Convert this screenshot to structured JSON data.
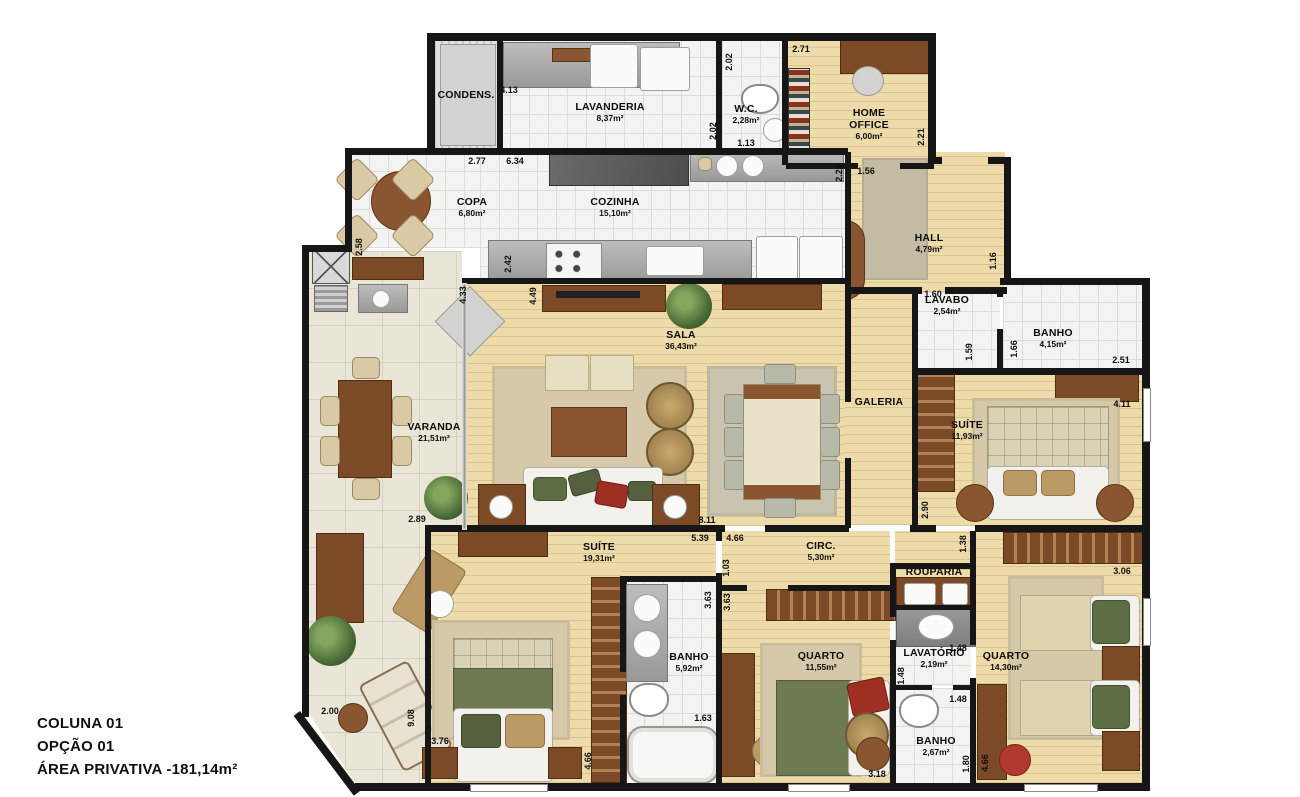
{
  "floorplan": {
    "footer": {
      "line1": "COLUNA 01",
      "line2": "OPÇÃO 01",
      "line3": "ÁREA PRIVATIVA -181,14m²"
    },
    "colors": {
      "wall": "#161616",
      "wood_floor": "#eedbaa",
      "tile_floor": "#f3f3f1",
      "varanda_floor": "#eae6d7",
      "furniture_brown": "#8a5531"
    },
    "rooms": [
      {
        "id": "condens",
        "name": "CONDENS.",
        "area": "",
        "x": 466,
        "y": 95
      },
      {
        "id": "lavanderia",
        "name": "LAVANDERIA",
        "area": "8,37m²",
        "x": 610,
        "y": 112
      },
      {
        "id": "wc",
        "name": "W.C.",
        "area": "2,28m²",
        "x": 746,
        "y": 114
      },
      {
        "id": "home-office",
        "name": "HOME OFFICE",
        "area": "6,00m²",
        "x": 869,
        "y": 124,
        "wrap": true
      },
      {
        "id": "copa",
        "name": "COPA",
        "area": "6,80m²",
        "x": 472,
        "y": 207
      },
      {
        "id": "cozinha",
        "name": "COZINHA",
        "area": "15,10m²",
        "x": 615,
        "y": 207
      },
      {
        "id": "hall",
        "name": "HALL",
        "area": "4,79m²",
        "x": 929,
        "y": 243
      },
      {
        "id": "lavabo",
        "name": "LAVABO",
        "area": "2,54m²",
        "x": 947,
        "y": 305
      },
      {
        "id": "banho-social",
        "name": "BANHO",
        "area": "4,15m²",
        "x": 1053,
        "y": 338
      },
      {
        "id": "sala",
        "name": "SALA",
        "area": "36,43m²",
        "x": 681,
        "y": 340
      },
      {
        "id": "galeria",
        "name": "GALERIA",
        "area": "",
        "x": 879,
        "y": 402
      },
      {
        "id": "varanda",
        "name": "VARANDA",
        "area": "21,51m²",
        "x": 434,
        "y": 432
      },
      {
        "id": "suite-1",
        "name": "SUÍTE",
        "area": "11,93m²",
        "x": 967,
        "y": 430
      },
      {
        "id": "suite-2",
        "name": "SUÍTE",
        "area": "19,31m²",
        "x": 599,
        "y": 552
      },
      {
        "id": "circ",
        "name": "CIRC.",
        "area": "5,30m²",
        "x": 821,
        "y": 551
      },
      {
        "id": "rouparia",
        "name": "ROUPARIA",
        "area": "",
        "x": 934,
        "y": 572
      },
      {
        "id": "banho-suite",
        "name": "BANHO",
        "area": "5,92m²",
        "x": 689,
        "y": 662
      },
      {
        "id": "quarto-1",
        "name": "QUARTO",
        "area": "11,55m²",
        "x": 821,
        "y": 661
      },
      {
        "id": "lavatorio",
        "name": "LAVATÓRIO",
        "area": "2,19m²",
        "x": 934,
        "y": 658
      },
      {
        "id": "quarto-2",
        "name": "QUARTO",
        "area": "14,30m²",
        "x": 1006,
        "y": 661
      },
      {
        "id": "banho-3",
        "name": "BANHO",
        "area": "2,67m²",
        "x": 936,
        "y": 746
      }
    ],
    "dimensions": [
      {
        "t": "4.13",
        "x": 509,
        "y": 90
      },
      {
        "t": "2.02",
        "x": 729,
        "y": 62,
        "v": 1
      },
      {
        "t": "2.71",
        "x": 801,
        "y": 49
      },
      {
        "t": "2.02",
        "x": 713,
        "y": 131,
        "v": 1
      },
      {
        "t": "1.13",
        "x": 746,
        "y": 143
      },
      {
        "t": "2.77",
        "x": 477,
        "y": 161
      },
      {
        "t": "6.34",
        "x": 515,
        "y": 161
      },
      {
        "t": "2.23",
        "x": 839,
        "y": 173,
        "v": 1
      },
      {
        "t": "1.56",
        "x": 866,
        "y": 171
      },
      {
        "t": "2.21",
        "x": 921,
        "y": 137,
        "v": 1
      },
      {
        "t": "2.58",
        "x": 359,
        "y": 247,
        "v": 1
      },
      {
        "t": "2.42",
        "x": 508,
        "y": 264,
        "v": 1
      },
      {
        "t": "1.16",
        "x": 993,
        "y": 261,
        "v": 1
      },
      {
        "t": "1.60",
        "x": 933,
        "y": 294
      },
      {
        "t": "1.59",
        "x": 969,
        "y": 352,
        "v": 1
      },
      {
        "t": "1.66",
        "x": 1014,
        "y": 349,
        "v": 1
      },
      {
        "t": "2.51",
        "x": 1121,
        "y": 360
      },
      {
        "t": "4.33",
        "x": 463,
        "y": 295,
        "v": 1
      },
      {
        "t": "4.49",
        "x": 533,
        "y": 296,
        "v": 1
      },
      {
        "t": "4.11",
        "x": 1122,
        "y": 404
      },
      {
        "t": "2.90",
        "x": 925,
        "y": 510,
        "v": 1
      },
      {
        "t": "1.38",
        "x": 963,
        "y": 544,
        "v": 1
      },
      {
        "t": "8.11",
        "x": 707,
        "y": 520
      },
      {
        "t": "2.89",
        "x": 417,
        "y": 519
      },
      {
        "t": "5.39",
        "x": 700,
        "y": 538
      },
      {
        "t": "4.66",
        "x": 735,
        "y": 538
      },
      {
        "t": "1.03",
        "x": 726,
        "y": 568,
        "v": 1
      },
      {
        "t": "3.63",
        "x": 708,
        "y": 600,
        "v": 1
      },
      {
        "t": "3.63",
        "x": 727,
        "y": 602,
        "v": 1
      },
      {
        "t": "2.00",
        "x": 330,
        "y": 711
      },
      {
        "t": "9.08",
        "x": 411,
        "y": 718,
        "v": 1
      },
      {
        "t": "3.76",
        "x": 440,
        "y": 741
      },
      {
        "t": "4.66",
        "x": 588,
        "y": 761,
        "v": 1
      },
      {
        "t": "1.63",
        "x": 703,
        "y": 718
      },
      {
        "t": "3.06",
        "x": 1122,
        "y": 571
      },
      {
        "t": "1.48",
        "x": 958,
        "y": 648
      },
      {
        "t": "1.48",
        "x": 901,
        "y": 676,
        "v": 1
      },
      {
        "t": "1.48",
        "x": 958,
        "y": 699
      },
      {
        "t": "1.80",
        "x": 966,
        "y": 764,
        "v": 1
      },
      {
        "t": "4.66",
        "x": 985,
        "y": 763,
        "v": 1
      },
      {
        "t": "3.18",
        "x": 877,
        "y": 774
      }
    ]
  }
}
